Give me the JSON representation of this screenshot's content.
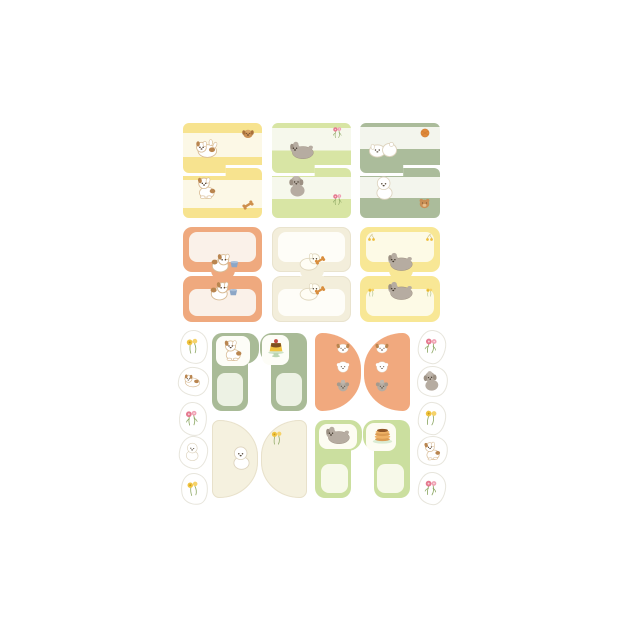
{
  "canvas": {
    "width": 624,
    "height": 625,
    "background": "#FFFFFF"
  },
  "sheet_name": "puppy-memo-note-sheet",
  "pads": [
    {
      "name": "memo-pad-yellow-stripe",
      "shape": "step",
      "x": 183,
      "y": 123,
      "w": 79,
      "h": 95,
      "base": "#F7E38F",
      "inner": "#FCF8E6",
      "top": {
        "bands": [
          20,
          68
        ],
        "icons": [
          {
            "icon": "puppy-tumble",
            "name": "tumbling-puppy-icon",
            "x": 10,
            "y": 12,
            "s": 27
          },
          {
            "icon": "dog-head",
            "name": "brown-dog-head-icon",
            "x": 57,
            "y": 2,
            "s": 16
          }
        ]
      },
      "bottom": {
        "bands": [
          24,
          80
        ],
        "icons": [
          {
            "icon": "puppy-sit",
            "name": "sitting-puppy-icon",
            "x": 10,
            "y": 6,
            "s": 26
          },
          {
            "icon": "bone",
            "name": "bone-icon",
            "x": 57,
            "y": 29,
            "s": 16
          }
        ]
      }
    },
    {
      "name": "memo-pad-green-stripe",
      "shape": "step",
      "x": 272,
      "y": 123,
      "w": 79,
      "h": 95,
      "base": "#D8E5A4",
      "inner": "#F6F8EC",
      "top": {
        "bands": [
          10,
          55
        ],
        "icons": [
          {
            "icon": "poodle-lie",
            "name": "lying-poodle-icon",
            "x": 16,
            "y": 13,
            "s": 28
          },
          {
            "icon": "flowers-pink",
            "name": "pink-flowers-icon",
            "x": 58,
            "y": 2,
            "s": 15
          }
        ]
      },
      "bottom": {
        "bands": [
          18,
          62
        ],
        "icons": [
          {
            "icon": "poodle-sit",
            "name": "sitting-poodle-icon",
            "x": 13,
            "y": 5,
            "s": 25
          },
          {
            "icon": "flowers-pink",
            "name": "pink-flowers-icon",
            "x": 58,
            "y": 24,
            "s": 15
          }
        ]
      }
    },
    {
      "name": "memo-pad-sage-stripe",
      "shape": "step",
      "x": 360,
      "y": 123,
      "w": 80,
      "h": 95,
      "base": "#ABBC9B",
      "inner": "#F3F5ED",
      "top": {
        "bands": [
          8,
          52
        ],
        "icons": [
          {
            "icon": "dogs-play",
            "name": "playing-white-dogs-icon",
            "x": 8,
            "y": 12,
            "s": 30
          },
          {
            "icon": "ball",
            "name": "orange-ball-icon",
            "x": 58,
            "y": 2,
            "s": 14
          }
        ]
      },
      "bottom": {
        "bands": [
          18,
          60
        ],
        "icons": [
          {
            "icon": "bichon-sit",
            "name": "sitting-bichon-icon",
            "x": 11,
            "y": 6,
            "s": 27
          },
          {
            "icon": "teddy",
            "name": "teddy-bear-icon",
            "x": 56,
            "y": 27,
            "s": 17
          }
        ]
      }
    },
    {
      "name": "memo-pad-orange-frame",
      "shape": "tab",
      "x": 183,
      "y": 227,
      "w": 79,
      "h": 95,
      "base": "#EFA97E",
      "inner": "#FAF1E9",
      "top": {
        "icons": [
          {
            "icon": "dog-bowl",
            "name": "puppy-with-bowl-icon",
            "x": 26,
            "y": 21,
            "s": 30
          }
        ]
      },
      "bottom": {
        "icons": [
          {
            "icon": "dog-bowl",
            "name": "puppy-with-bowl-icon",
            "x": 25,
            "y": 0,
            "s": 30
          }
        ]
      }
    },
    {
      "name": "memo-pad-cream-frame",
      "shape": "tab",
      "x": 272,
      "y": 227,
      "w": 79,
      "h": 95,
      "base": "#F3EEDB",
      "inner": "#FEFDF8",
      "edge": "#E9E3CE",
      "top": {
        "icons": [
          {
            "icon": "dog-bone",
            "name": "dog-with-bone-icon",
            "x": 25,
            "y": 20,
            "s": 29
          }
        ]
      },
      "bottom": {
        "icons": [
          {
            "icon": "dog-bone",
            "name": "dog-with-bone-icon",
            "x": 25,
            "y": 1,
            "s": 29
          }
        ]
      }
    },
    {
      "name": "memo-pad-yellow-frame",
      "shape": "tab",
      "x": 360,
      "y": 227,
      "w": 80,
      "h": 95,
      "base": "#F8E795",
      "inner": "#FDFAE6",
      "top": {
        "icons": [
          {
            "icon": "cherries-yellow",
            "name": "yellow-cherries-icon",
            "x": 5,
            "y": 3,
            "s": 13
          },
          {
            "icon": "cherries-yellow",
            "name": "yellow-cherries-icon",
            "x": 63,
            "y": 3,
            "s": 13
          },
          {
            "icon": "poodle-lie",
            "name": "lying-poodle-icon",
            "x": 26,
            "y": 20,
            "s": 29
          }
        ]
      },
      "bottom": {
        "icons": [
          {
            "icon": "poodle-lie",
            "name": "lying-poodle-icon",
            "x": 26,
            "y": 0,
            "s": 29
          },
          {
            "icon": "flowers-yellow",
            "name": "yellow-flowers-icon",
            "x": 6,
            "y": 7,
            "s": 11
          },
          {
            "icon": "flowers-yellow",
            "name": "yellow-flowers-icon",
            "x": 64,
            "y": 7,
            "s": 11
          }
        ]
      }
    },
    {
      "name": "memo-pad-sage-arch",
      "shape": "arch",
      "x": 212,
      "y": 333,
      "w": 95,
      "h": 78,
      "base": "#A9BB97",
      "inner": "#EDF2E4",
      "patch": "#FDFDF7",
      "left": {
        "patch": [
          4,
          3,
          34,
          30
        ],
        "panel": [
          5,
          40,
          26,
          33
        ],
        "icons": [
          {
            "icon": "puppy-sit",
            "name": "sitting-puppy-icon",
            "x": 8,
            "y": 4,
            "s": 25
          }
        ]
      },
      "right": {
        "patch": [
          2,
          2,
          27,
          30
        ],
        "panel": [
          16,
          40,
          26,
          33
        ],
        "icons": [
          {
            "icon": "pudding",
            "name": "pudding-icon",
            "x": 3,
            "y": 2,
            "s": 26
          }
        ]
      }
    },
    {
      "name": "memo-pad-orange-dome",
      "shape": "dome",
      "x": 315,
      "y": 333,
      "w": 95,
      "h": 78,
      "base": "#F1A97E",
      "left": {
        "icons": [
          {
            "icon": "face-puppy",
            "name": "puppy-face-icon",
            "x": 19,
            "y": 6,
            "s": 18
          },
          {
            "icon": "face-bichon",
            "name": "bichon-face-icon",
            "x": 19,
            "y": 25,
            "s": 18
          },
          {
            "icon": "face-poodle",
            "name": "poodle-face-icon",
            "x": 19,
            "y": 44,
            "s": 18
          }
        ]
      },
      "right": {
        "icons": [
          {
            "icon": "face-puppy",
            "name": "puppy-face-icon",
            "x": 9,
            "y": 6,
            "s": 18
          },
          {
            "icon": "face-bichon",
            "name": "bichon-face-icon",
            "x": 9,
            "y": 25,
            "s": 18
          },
          {
            "icon": "face-poodle",
            "name": "poodle-face-icon",
            "x": 9,
            "y": 44,
            "s": 18
          }
        ]
      }
    },
    {
      "name": "memo-pad-cream-dome",
      "shape": "dome",
      "x": 212,
      "y": 420,
      "w": 95,
      "h": 78,
      "base": "#F5F1DF",
      "edge": "#E8E1CB",
      "left": {
        "icons": [
          {
            "icon": "bichon-sit",
            "name": "sitting-bichon-icon",
            "x": 16,
            "y": 24,
            "s": 27
          }
        ]
      },
      "right": {
        "icons": [
          {
            "icon": "flowers-yellow",
            "name": "yellow-flowers-icon",
            "x": 7,
            "y": 9,
            "s": 18
          }
        ]
      }
    },
    {
      "name": "memo-pad-green-arch",
      "shape": "arch",
      "x": 315,
      "y": 420,
      "w": 95,
      "h": 78,
      "base": "#CBDF9F",
      "inner": "#F7F9E9",
      "patch": "#FDFCF2",
      "left": {
        "patch": [
          4,
          4,
          38,
          25
        ],
        "panel": [
          6,
          44,
          27,
          29
        ],
        "icons": [
          {
            "icon": "poodle-lie",
            "name": "lying-poodle-icon",
            "x": 9,
            "y": 1,
            "s": 28
          }
        ]
      },
      "right": {
        "patch": [
          3,
          3,
          30,
          28
        ],
        "panel": [
          14,
          44,
          27,
          29
        ],
        "icons": [
          {
            "icon": "pancakes",
            "name": "pancakes-icon",
            "x": 6,
            "y": 2,
            "s": 27
          }
        ]
      }
    }
  ],
  "stickers": [
    {
      "name": "sticker-yellow-flowers",
      "icon": "flowers-yellow",
      "icon_name": "yellow-flowers-icon",
      "x": 180,
      "y": 330,
      "w": 26,
      "h": 32,
      "rot": -6
    },
    {
      "name": "sticker-lying-puppy",
      "icon": "puppy-lie",
      "icon_name": "lying-puppy-icon",
      "x": 178,
      "y": 367,
      "w": 29,
      "h": 27,
      "rot": 5
    },
    {
      "name": "sticker-pink-flowers",
      "icon": "flowers-pink",
      "icon_name": "pink-flowers-icon",
      "x": 179,
      "y": 402,
      "w": 26,
      "h": 32,
      "rot": -4
    },
    {
      "name": "sticker-white-dog",
      "icon": "bichon-sit",
      "icon_name": "sitting-bichon-icon",
      "x": 179,
      "y": 436,
      "w": 27,
      "h": 31,
      "rot": 6
    },
    {
      "name": "sticker-yellow-flowers",
      "icon": "flowers-yellow",
      "icon_name": "yellow-flowers-icon",
      "x": 181,
      "y": 473,
      "w": 25,
      "h": 30,
      "rot": -8
    },
    {
      "name": "sticker-pink-flowers",
      "icon": "flowers-pink",
      "icon_name": "pink-flowers-icon",
      "x": 418,
      "y": 330,
      "w": 26,
      "h": 32,
      "rot": 7
    },
    {
      "name": "sticker-gray-poodle",
      "icon": "poodle-sit",
      "icon_name": "sitting-poodle-icon",
      "x": 417,
      "y": 366,
      "w": 29,
      "h": 29,
      "rot": -5
    },
    {
      "name": "sticker-yellow-flowers",
      "icon": "flowers-yellow",
      "icon_name": "yellow-flowers-icon",
      "x": 418,
      "y": 402,
      "w": 26,
      "h": 31,
      "rot": 6
    },
    {
      "name": "sticker-brown-puppy",
      "icon": "puppy-sit",
      "icon_name": "sitting-puppy-icon",
      "x": 417,
      "y": 436,
      "w": 29,
      "h": 28,
      "rot": -6
    },
    {
      "name": "sticker-pink-flowers",
      "icon": "flowers-pink",
      "icon_name": "pink-flowers-icon",
      "x": 418,
      "y": 472,
      "w": 26,
      "h": 31,
      "rot": 5
    }
  ]
}
